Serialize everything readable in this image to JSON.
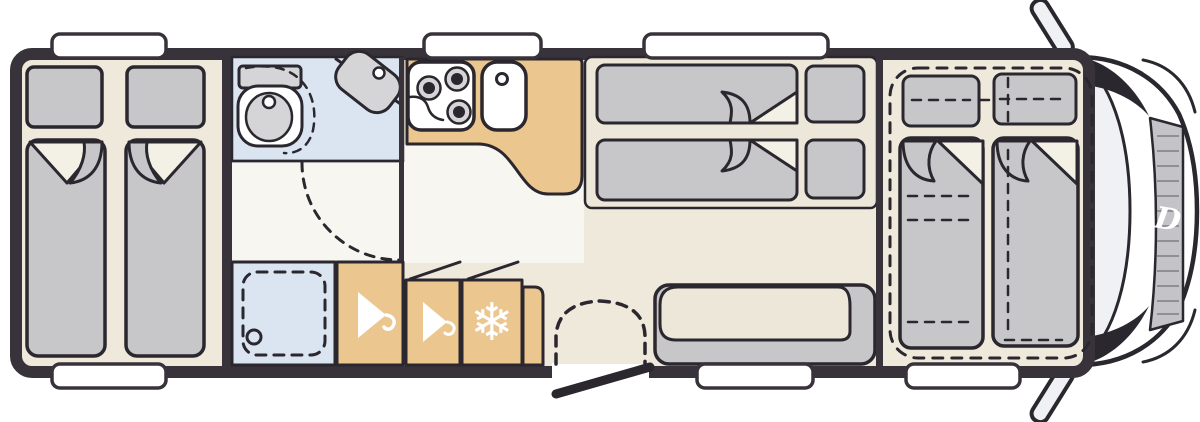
{
  "palette": {
    "wall": "#38333b",
    "outline": "#2b272e",
    "floor": "#efe9dc",
    "floor_light": "#f8f6f1",
    "platform": "#ece7d9",
    "wood": "#ecc68f",
    "bath_blue": "#dbe5f2",
    "cushion": "#c7c7c9",
    "fixture": "#d5d5d7",
    "sheet": "#f3f0e6",
    "pure_white": "#ffffff",
    "glass": "#f0f1f5",
    "grille": "#c4c4c8",
    "grille_slat": "#8f8f94"
  },
  "icons": {
    "fridge": {
      "name": "snowflake-icon",
      "glyph": "❄"
    },
    "wardrobe": {
      "name": "hanger-icon"
    },
    "brand": {
      "name": "brand-letter",
      "glyph": "D"
    }
  }
}
